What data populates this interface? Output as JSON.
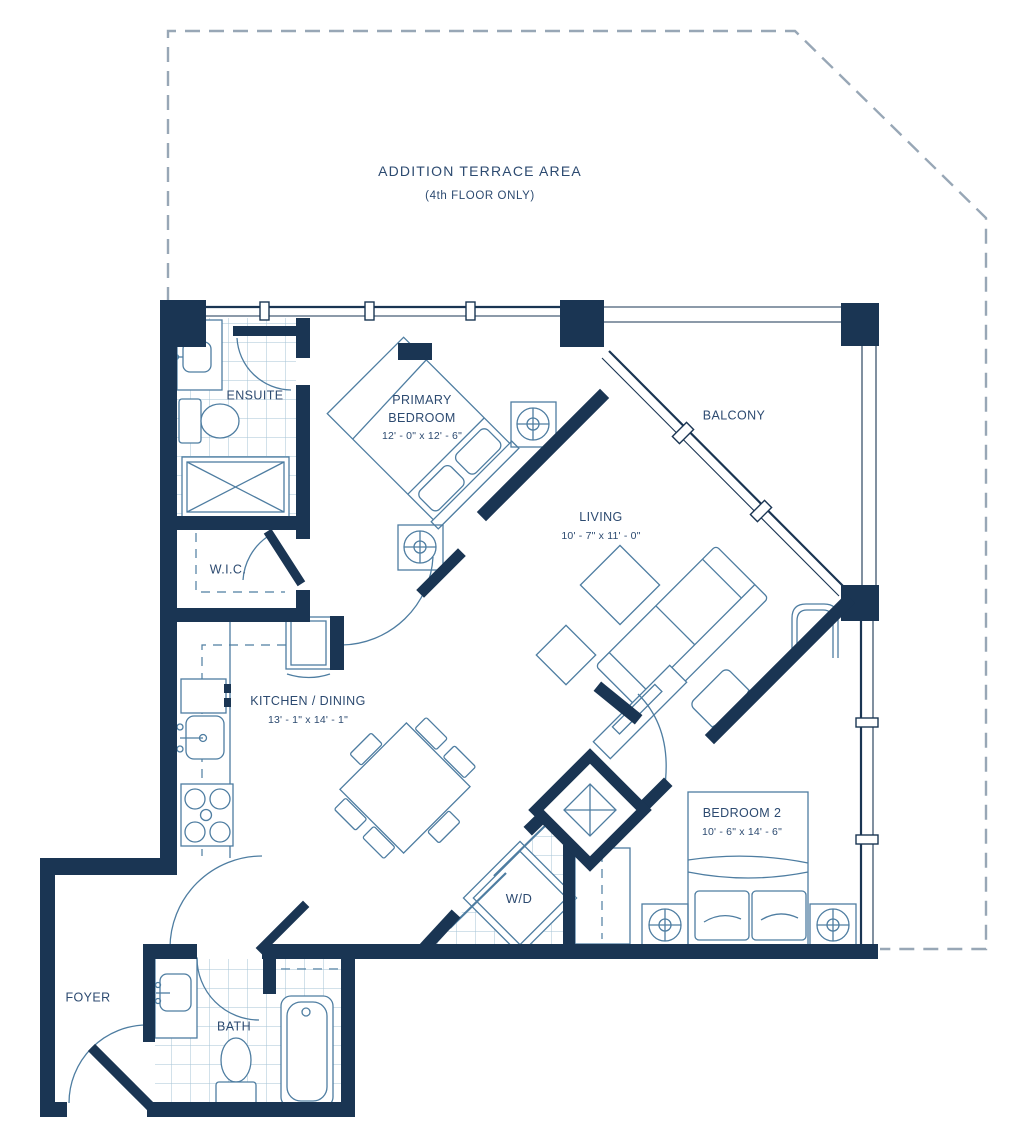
{
  "colors": {
    "wall": "#1A3553",
    "line": "#4E7DA1",
    "line_light": "#A6C3D6",
    "text": "#2C4A70",
    "dash": "#98A7B6"
  },
  "terrace": {
    "title": "ADDITION TERRACE AREA",
    "subtitle": "(4th FLOOR ONLY)"
  },
  "rooms": {
    "ensuite": {
      "name": "ENSUITE"
    },
    "primary_bedroom": {
      "name": "PRIMARY BEDROOM",
      "dims": "12' - 0\" x 12' - 6\""
    },
    "balcony": {
      "name": "BALCONY"
    },
    "living": {
      "name": "LIVING",
      "dims": "10' - 7\" x 11' - 0\""
    },
    "wic": {
      "name": "W.I.C."
    },
    "kitchen_dining": {
      "name": "KITCHEN / DINING",
      "dims": "13' - 1\" x 14' - 1\""
    },
    "bedroom2": {
      "name": "BEDROOM 2",
      "dims": "10' - 6\" x 14' - 6\""
    },
    "wd": {
      "name": "W/D"
    },
    "foyer": {
      "name": "FOYER"
    },
    "bath": {
      "name": "BATH"
    }
  }
}
